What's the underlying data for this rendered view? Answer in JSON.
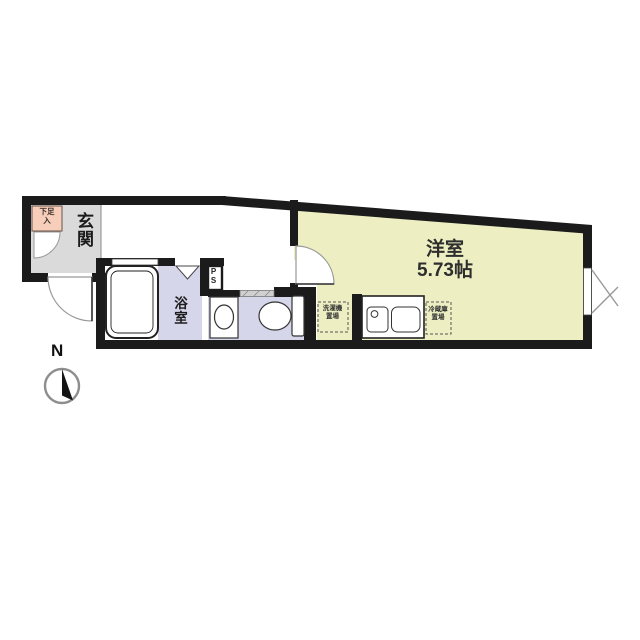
{
  "floorplan": {
    "rooms": {
      "entrance": {
        "label": "玄関"
      },
      "shoe_storage": {
        "label": "下足\n入"
      },
      "bathroom": {
        "label": "浴室"
      },
      "pipe_space": {
        "label": "PS"
      },
      "western_room": {
        "label": "洋室",
        "size": "5.73帖"
      },
      "washer_place": {
        "label": "洗濯機\n置場"
      },
      "fridge_place": {
        "label": "冷蔵庫\n置場"
      }
    },
    "compass": {
      "north": "N"
    },
    "colors": {
      "western_room_floor": "#edefc3",
      "bathroom_floor": "#d6d6ea",
      "toilet_floor": "#d6d6ea",
      "entrance_floor": "#dadada",
      "shoe_storage_fill": "#f6ceb9",
      "wall": "#1b1b1b"
    }
  }
}
